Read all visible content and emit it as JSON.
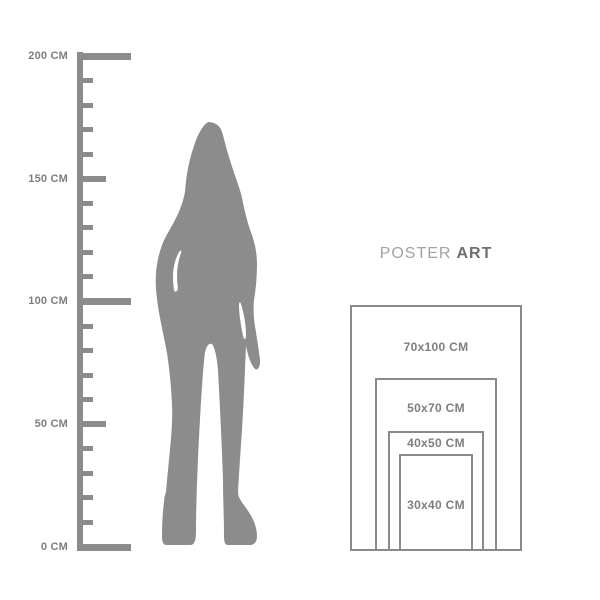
{
  "brand": {
    "word_light": "POSTER",
    "word_bold": "ART"
  },
  "ruler": {
    "unit": "CM",
    "min_cm": 0,
    "max_cm": 200,
    "tick_interval_cm": 10,
    "labels": [
      "200 CM",
      "150 CM",
      "100 CM",
      "50 CM",
      "0 CM"
    ]
  },
  "figure": {
    "silhouette": "standing-woman"
  },
  "poster_sizes": [
    {
      "label": "70x100 CM",
      "width_cm": 70,
      "height_cm": 100
    },
    {
      "label": "50x70 CM",
      "width_cm": 50,
      "height_cm": 70
    },
    {
      "label": "40x50 CM",
      "width_cm": 40,
      "height_cm": 50
    },
    {
      "label": "30x40 CM",
      "width_cm": 30,
      "height_cm": 40
    }
  ],
  "colors": {
    "background": "#ffffff",
    "silhouette": "#8c8c8c",
    "ruler": "#8c8c8c",
    "frame_border": "#8a8a8a",
    "label_text": "#7e7e7e",
    "brand_light": "#a3a3a3",
    "brand_bold": "#6f6f6f"
  }
}
